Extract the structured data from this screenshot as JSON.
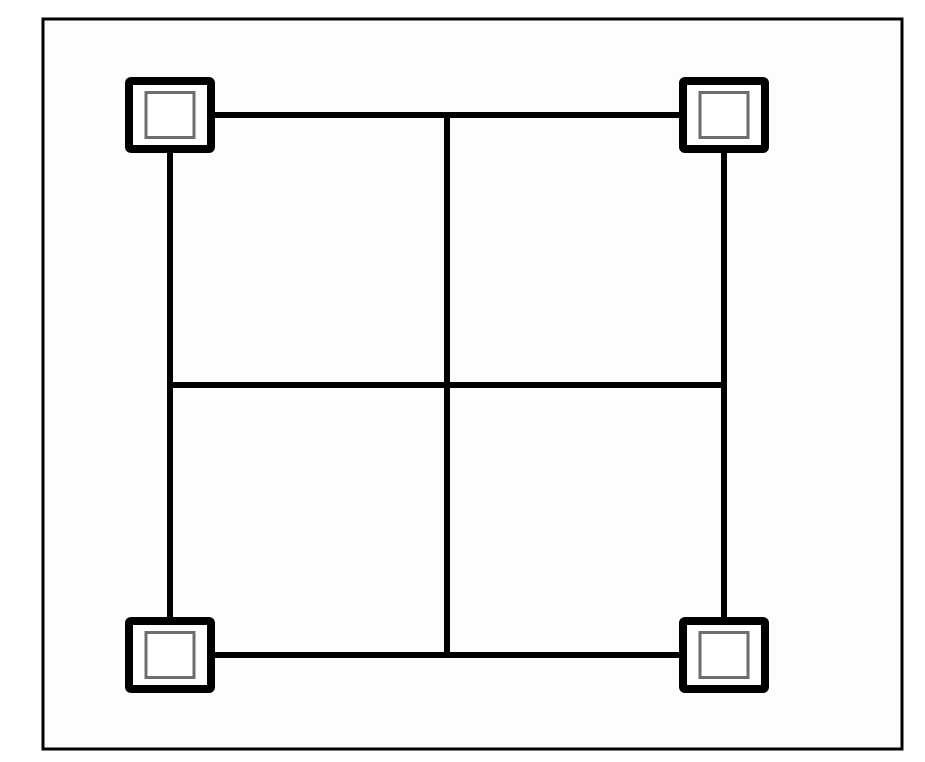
{
  "window": {
    "background_color": "#ffffff"
  },
  "canvas": {
    "background_color": "#fdfdfd",
    "border_color": "#000000",
    "border_width": 3,
    "x": 43,
    "y": 19,
    "width": 859,
    "height": 730
  },
  "diagram": {
    "type": "graph",
    "description": "Square subdivided into a 2x2 grid by a middle vertical and middle horizontal line, with four double-square corner nodes",
    "edge_color": "#000000",
    "edge_width": 6,
    "mid_x": 447,
    "mid_y": 385,
    "edges": [
      {
        "name": "top-edge",
        "x1": 170,
        "y1": 115,
        "x2": 724,
        "y2": 115
      },
      {
        "name": "bottom-edge",
        "x1": 170,
        "y1": 655,
        "x2": 724,
        "y2": 655
      },
      {
        "name": "left-edge",
        "x1": 170,
        "y1": 115,
        "x2": 170,
        "y2": 655
      },
      {
        "name": "right-edge",
        "x1": 724,
        "y1": 115,
        "x2": 724,
        "y2": 655
      },
      {
        "name": "middle-vertical-edge",
        "x1": 447,
        "y1": 115,
        "x2": 447,
        "y2": 655
      },
      {
        "name": "middle-horizontal-edge",
        "x1": 170,
        "y1": 385,
        "x2": 724,
        "y2": 385
      }
    ],
    "node_style": {
      "fill": "#ffffff",
      "outer_rect_width": 82,
      "outer_rect_height": 68,
      "outer_stroke_width": 8,
      "outer_stroke_color": "#000000",
      "outer_corner_radius": 2,
      "inner_rect_width": 48,
      "inner_rect_height": 45,
      "inner_stroke_width": 3,
      "inner_stroke_color": "#6e6e6e"
    },
    "nodes": [
      {
        "id": "node-top-left",
        "cx": 170,
        "cy": 115
      },
      {
        "id": "node-top-right",
        "cx": 724,
        "cy": 115
      },
      {
        "id": "node-bottom-left",
        "cx": 170,
        "cy": 655
      },
      {
        "id": "node-bottom-right",
        "cx": 724,
        "cy": 655
      }
    ]
  }
}
